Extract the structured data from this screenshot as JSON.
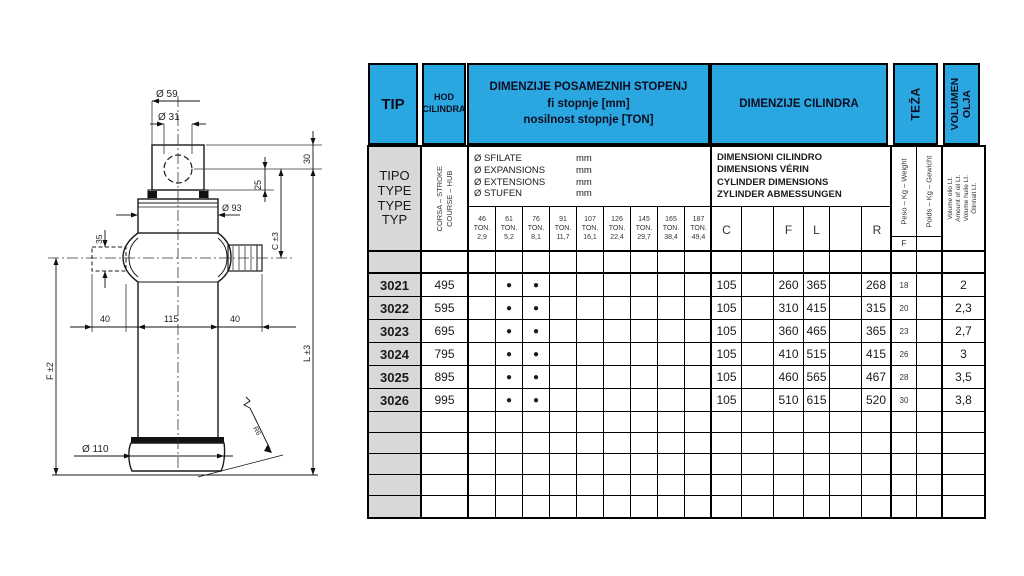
{
  "colors": {
    "header_blue": "#2aa7e0",
    "row_gray": "#d8d8d8",
    "border": "#000000"
  },
  "drawing": {
    "labels": {
      "dia_top": "Ø 59",
      "dia_eye": "Ø 31",
      "dim_head": "30",
      "dim_eye_offset": "25",
      "dia_stage1": "Ø 93",
      "dim_pin": "35",
      "dim_c": "C ±3",
      "dim_stub_left": "40",
      "dim_body": "115",
      "dim_stub_right": "40",
      "dim_l": "L ±3",
      "dim_f": "F ±2",
      "dia_base": "Ø 110",
      "radius_note": "R6"
    }
  },
  "table": {
    "header1": {
      "tip": "TIP",
      "hod1": "HOD",
      "hod2": "CILINDRA",
      "stages1": "DIMENZIJE POSAMEZNIH STOPENJ",
      "stages2": "fi stopnje [mm]",
      "stages3": "nosilnost stopnje [TON]",
      "cylinder": "DIMENZIJE CILINDRA",
      "weight": "TEŽA",
      "vol1": "VOLUMEN",
      "vol2": "OLJA"
    },
    "header2": {
      "tipo": [
        "TIPO",
        "TYPE",
        "TYPE",
        "TYP"
      ],
      "corsa1": "CORSA – STROKE",
      "corsa2": "COURSE – HUB",
      "stage_rows": [
        {
          "label": "Ø SFILATE",
          "unit": "mm"
        },
        {
          "label": "Ø EXPANSIONS",
          "unit": "mm"
        },
        {
          "label": "Ø EXTENSIONS",
          "unit": "mm"
        },
        {
          "label": "Ø STUFEN",
          "unit": "mm"
        }
      ],
      "tons": [
        {
          "dia": "46",
          "t": "TON.",
          "load": "2,9"
        },
        {
          "dia": "61",
          "t": "TON.",
          "load": "5,2"
        },
        {
          "dia": "76",
          "t": "TON.",
          "load": "8,1"
        },
        {
          "dia": "91",
          "t": "TON.",
          "load": "11,7"
        },
        {
          "dia": "107",
          "t": "TON.",
          "load": "16,1"
        },
        {
          "dia": "126",
          "t": "TON.",
          "load": "22,4"
        },
        {
          "dia": "145",
          "t": "TON.",
          "load": "29,7"
        },
        {
          "dia": "165",
          "t": "TON.",
          "load": "38,4"
        },
        {
          "dia": "187",
          "t": "TON.",
          "load": "49,4"
        }
      ],
      "cyl_lines": [
        "DIMENSIONI CILINDRO",
        "DIMENSIONS VÉRIN",
        "CYLINDER DIMENSIONS",
        "ZYLINDER ABMESSUNGEN"
      ],
      "cyl_cols": {
        "c": "C",
        "f": "F",
        "l": "L",
        "r": "R"
      },
      "peso": "Peso – Kg – Weight",
      "poids": "Poids – Kg – Gewicht",
      "peso_sub": "F",
      "vol_lines": [
        "Volume olio Lt.",
        "Amount of oil Lt.",
        "Volume huile Lt.",
        "Ölinhalt Lt."
      ]
    },
    "rows": [
      {
        "tip": "3021",
        "hod": "495",
        "dot": "●",
        "c": "105",
        "f": "260",
        "l": "365",
        "r": "268",
        "kg": "18",
        "vol": "2"
      },
      {
        "tip": "3022",
        "hod": "595",
        "dot": "●",
        "c": "105",
        "f": "310",
        "l": "415",
        "r": "315",
        "kg": "20",
        "vol": "2,3"
      },
      {
        "tip": "3023",
        "hod": "695",
        "dot": "●",
        "c": "105",
        "f": "360",
        "l": "465",
        "r": "365",
        "kg": "23",
        "vol": "2,7"
      },
      {
        "tip": "3024",
        "hod": "795",
        "dot": "●",
        "c": "105",
        "f": "410",
        "l": "515",
        "r": "415",
        "kg": "26",
        "vol": "3"
      },
      {
        "tip": "3025",
        "hod": "895",
        "dot": "●",
        "c": "105",
        "f": "460",
        "l": "565",
        "r": "467",
        "kg": "28",
        "vol": "3,5"
      },
      {
        "tip": "3026",
        "hod": "995",
        "dot": "●",
        "c": "105",
        "f": "510",
        "l": "615",
        "r": "520",
        "kg": "30",
        "vol": "3,8"
      }
    ]
  }
}
